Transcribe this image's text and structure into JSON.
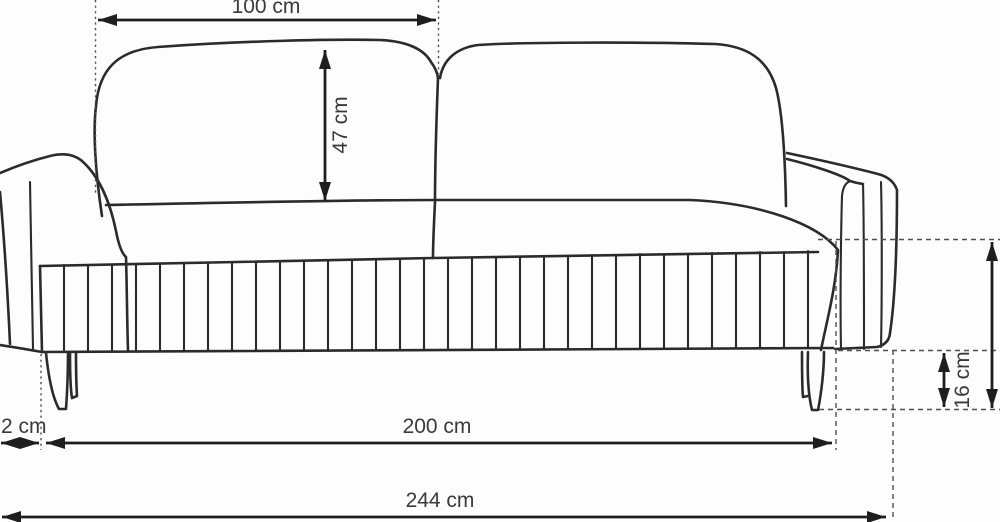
{
  "diagram": {
    "subject": "sofa front-view technical drawing with dimension annotations",
    "labels": {
      "backrest_width": "100 cm",
      "backrest_height": "47 cm",
      "armrest_width": "2 cm",
      "seat_width": "200 cm",
      "total_width": "244 cm",
      "leg_height": "16 cm"
    }
  },
  "colors": {
    "outline": "#2b2b2b",
    "dimension": "#1e1e1e",
    "guide": "#4f4f4f",
    "label": "#3a3a3a",
    "background": "#fdfdfd"
  }
}
